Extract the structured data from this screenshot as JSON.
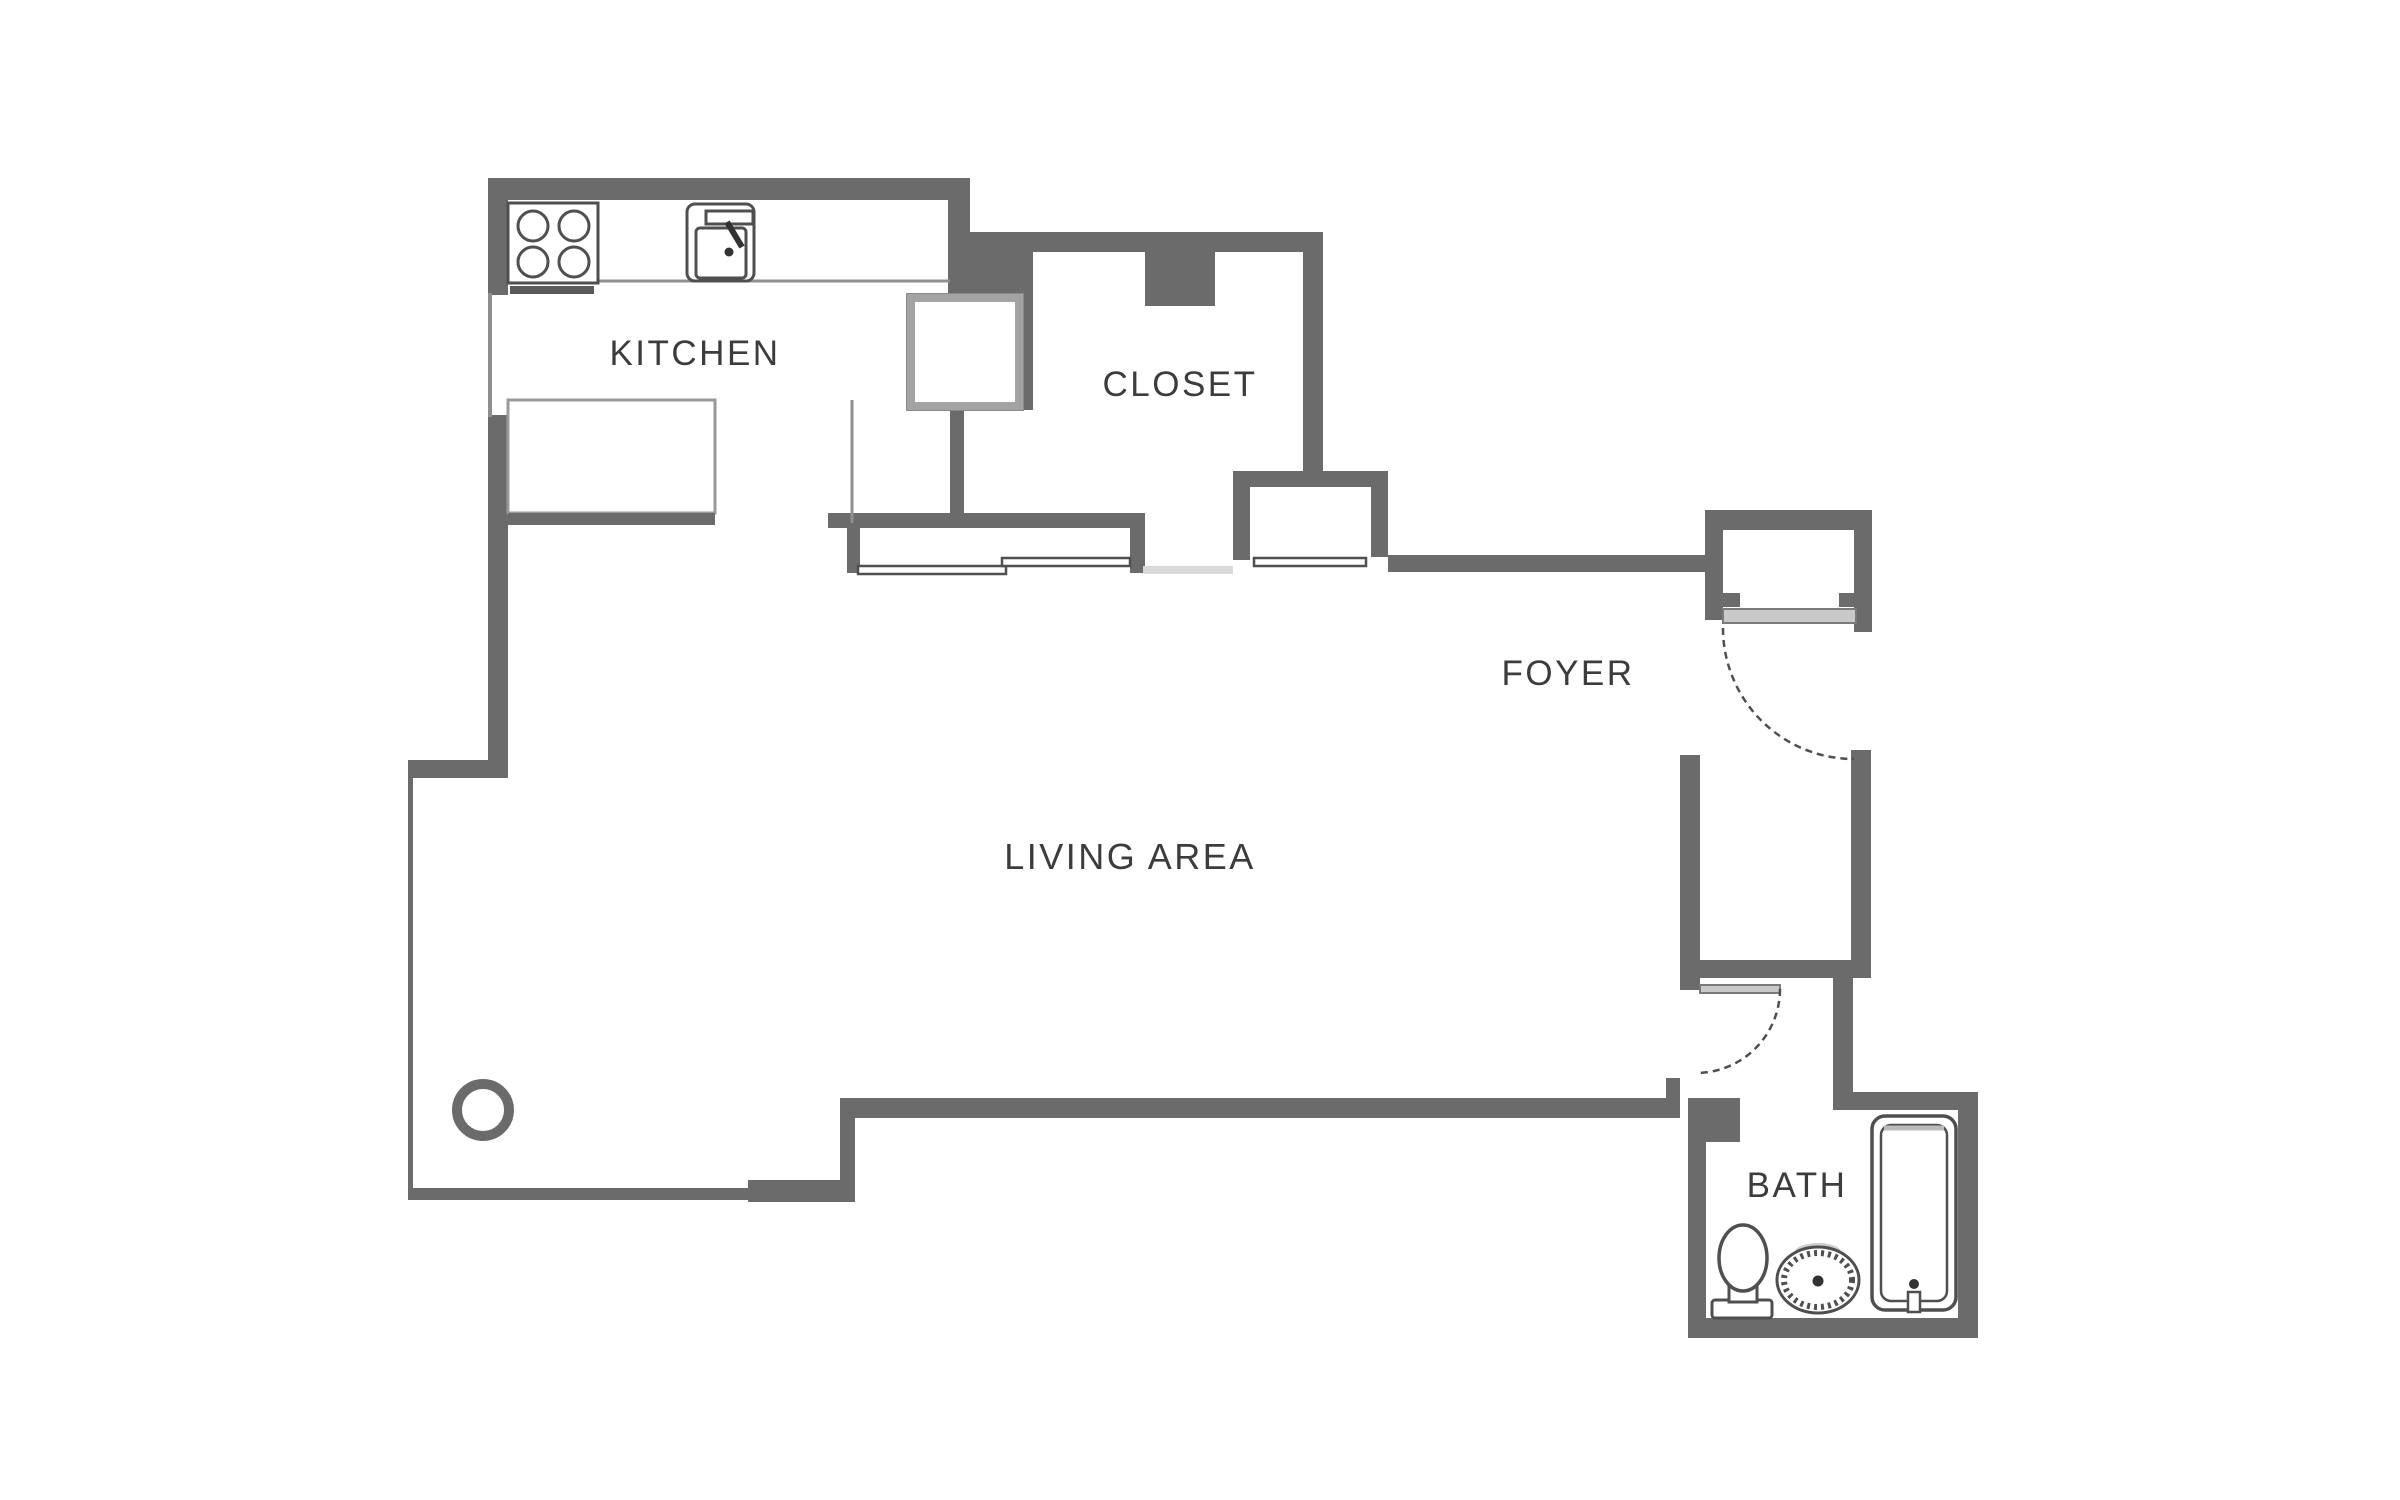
{
  "theme": {
    "wall": "#6b6b6b",
    "line": "#4f4f4f",
    "fixture_light": "#c9c9c9",
    "counter": "#8f8f8f",
    "text": "#3c3c3c",
    "bg": "#ffffff"
  },
  "rooms": {
    "kitchen": {
      "label": "KITCHEN"
    },
    "closet": {
      "label": "CLOSET"
    },
    "foyer": {
      "label": "FOYER"
    },
    "living": {
      "label": "LIVING AREA"
    },
    "bath": {
      "label": "BATH"
    }
  },
  "icons": [
    "stove-icon",
    "kitchen-sink-icon",
    "window-icon",
    "counter-icon",
    "shaft-icon",
    "sliding-door-icon",
    "entry-door-icon",
    "interior-door-icon",
    "column-icon",
    "toilet-icon",
    "bath-sink-icon",
    "bathtub-icon"
  ]
}
